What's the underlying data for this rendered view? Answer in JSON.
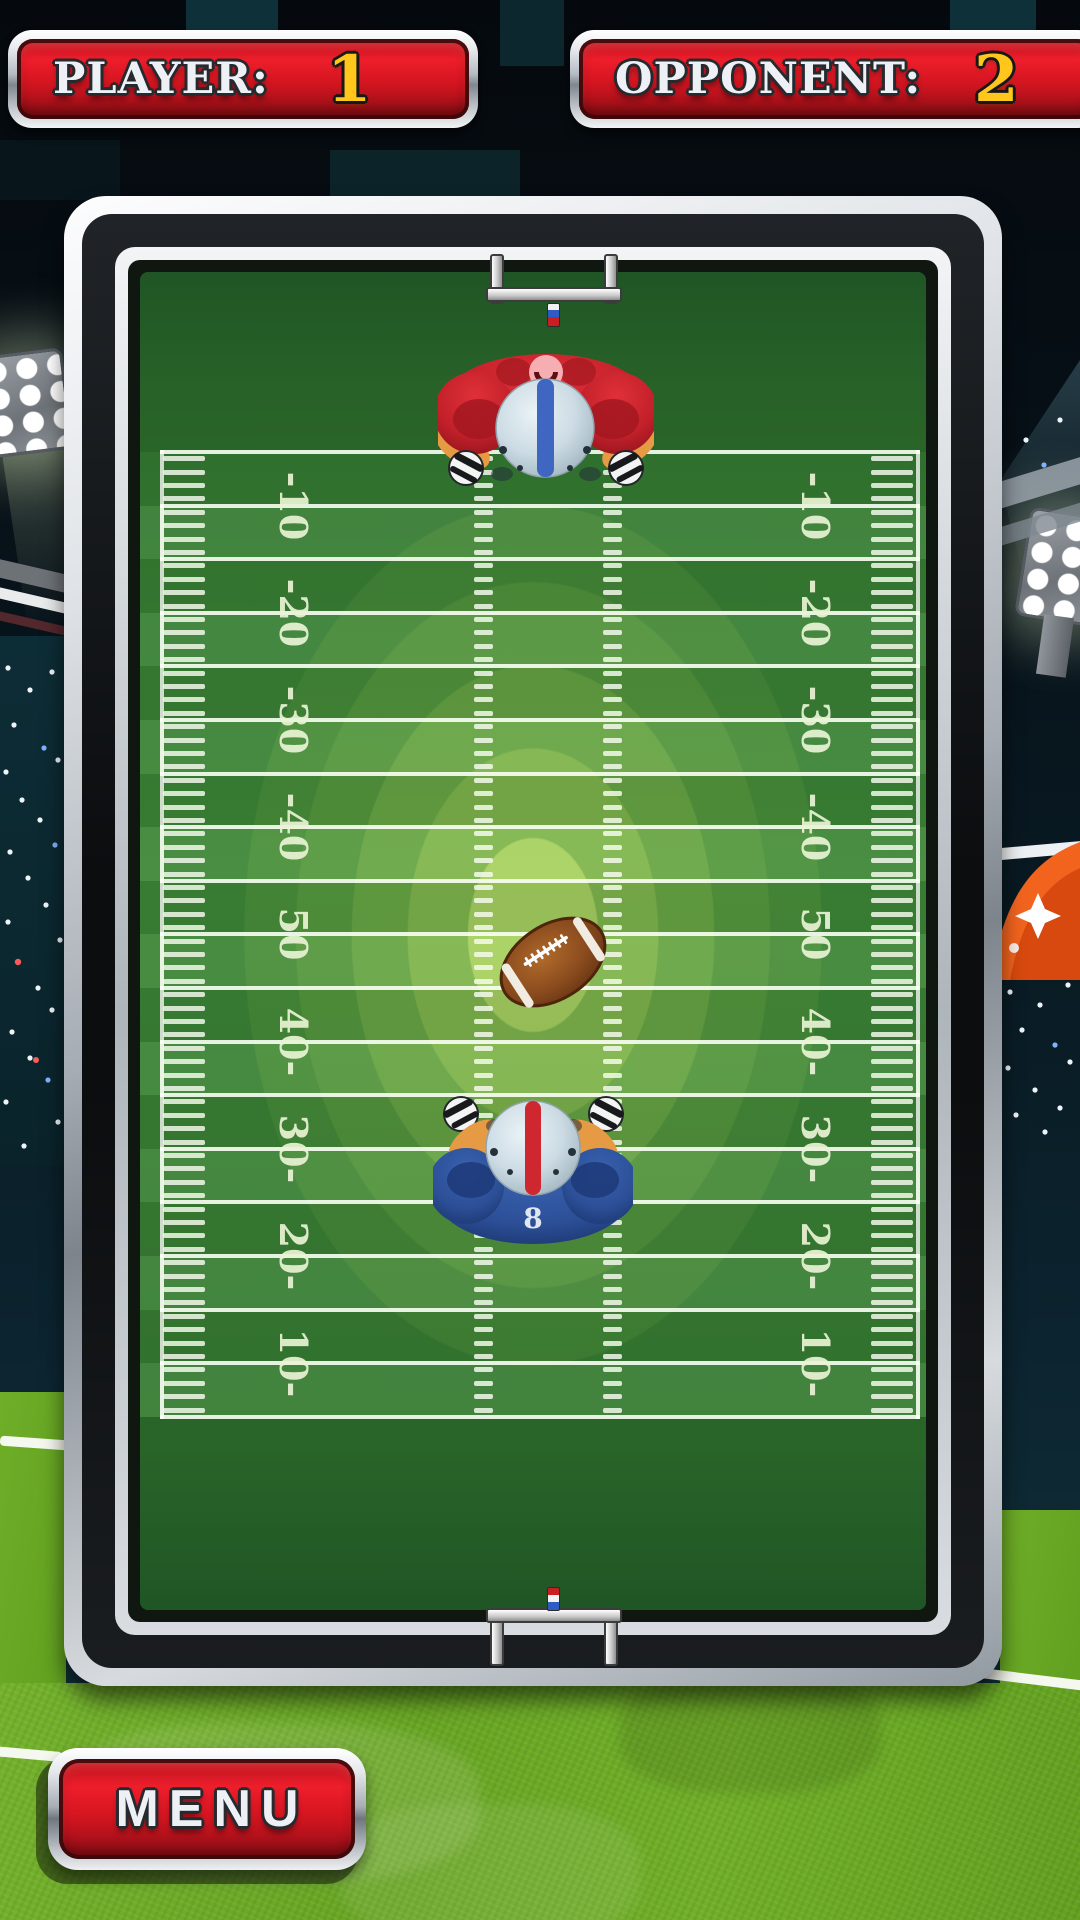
{
  "scoreboard": {
    "player_label": "PLAYER:",
    "player_score": "1",
    "opponent_label": "OPPONENT:",
    "opponent_score": "2"
  },
  "menu": {
    "label": "MENU"
  },
  "field": {
    "yard_numbers_left": [
      "-10",
      "-20",
      "-30",
      "-40",
      "50",
      "40-",
      "30-",
      "20-",
      "10-"
    ],
    "yard_numbers_right": [
      "-10",
      "-20",
      "-30",
      "-40",
      "50",
      "40-",
      "30-",
      "20-",
      "10-"
    ],
    "player_jersey_number": "8"
  },
  "colors": {
    "panel_red": "#d31520",
    "score_gold": "#ffc71c",
    "field_green": "#3f8838",
    "grass_green": "#6aaa24",
    "jersey_red": "#c2202a",
    "jersey_blue": "#2c4f97",
    "helmet_silver": "#ccdbe4",
    "ball_brown": "#8a4b1e"
  }
}
